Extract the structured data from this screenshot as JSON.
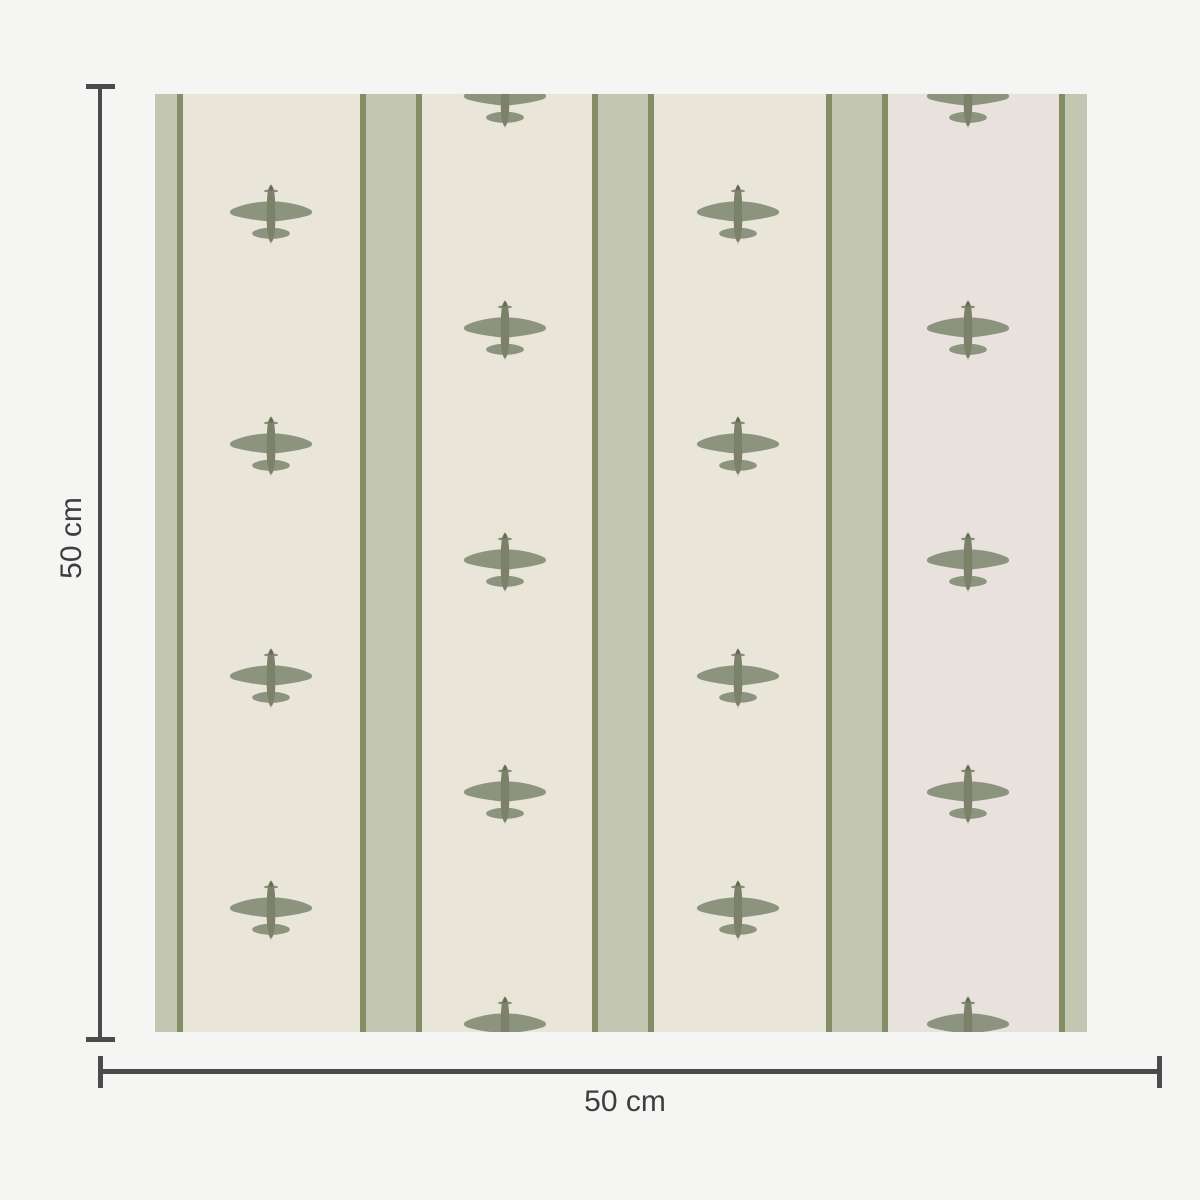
{
  "labels": {
    "width": "50 cm",
    "height": "50 cm"
  },
  "colors": {
    "page_bg": "#f5f5f3",
    "dimension": "#4b4b4b",
    "label_text": "#3e3e3e",
    "swatch_bg": "#e9e5d9",
    "swatch_bg_accent": "#e8e1dc",
    "stripe_band": "#c3c7b1",
    "stripe_edge": "#858d67",
    "plane_main": "#8d947e",
    "plane_body": "#7b8269",
    "plane_dark": "#666d55"
  },
  "pattern": {
    "motif_icon": "airplane-top-view-icon",
    "stripe_width": 62,
    "stripe_edge_width": 6,
    "stripe_centers": [
      -3,
      236,
      468,
      702,
      935
    ],
    "accent_column": {
      "from": 733,
      "to": 904
    },
    "plane": {
      "wingspan": 88,
      "length": 62
    },
    "plane_columns": [
      {
        "x": 116,
        "rows": [
          120,
          352,
          584,
          816
        ]
      },
      {
        "x": 350,
        "rows": [
          4,
          236,
          468,
          700,
          932
        ]
      },
      {
        "x": 583,
        "rows": [
          120,
          352,
          584,
          816
        ]
      },
      {
        "x": 813,
        "rows": [
          4,
          236,
          468,
          700,
          932
        ]
      }
    ]
  }
}
